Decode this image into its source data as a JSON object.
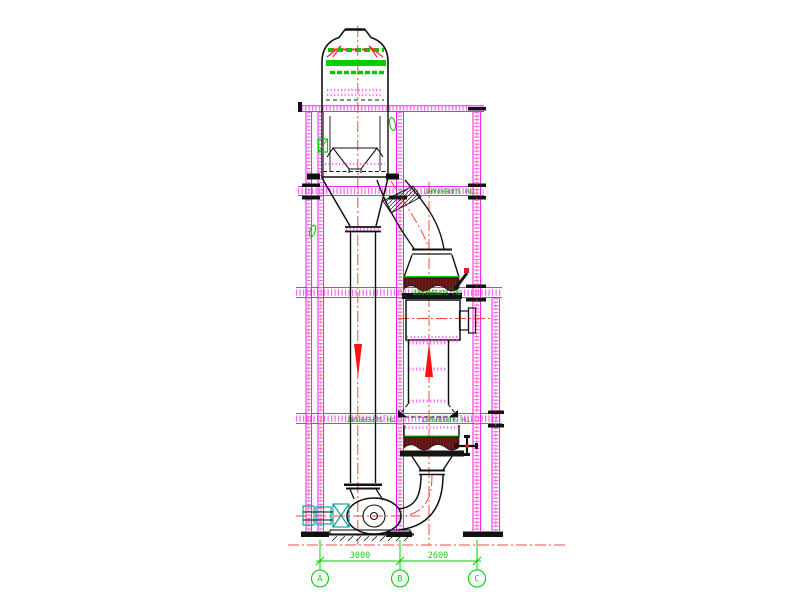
{
  "drawing": {
    "type": "cad-equipment-elevation",
    "background": "#ffffff",
    "labels": {
      "layer_tag_upper_beam": "TH_SUPERPART",
      "layer_tag_middle_beam": "TH_SUPERPART",
      "layer_tag_lower_beam_left": "TH_SUPERPART",
      "layer_tag_lower_beam_right": "TH_SUPERPART"
    },
    "dimensions": {
      "span_a_b": "3000",
      "span_b_c": "2600"
    },
    "grid_axes": {
      "a": "A",
      "b": "B",
      "c": "C"
    },
    "colors": {
      "structure_magenta": "#ee00ee",
      "structure_magenta_hatch": "#ff66ff",
      "annotation_green": "#00cc00",
      "centerline_red": "#ff4444",
      "flow_arrow_red": "#ff1111",
      "equipment_outline": "#111111",
      "drive_cyan": "#009999",
      "material_hatch_maroon": "#7a1e1e"
    }
  }
}
